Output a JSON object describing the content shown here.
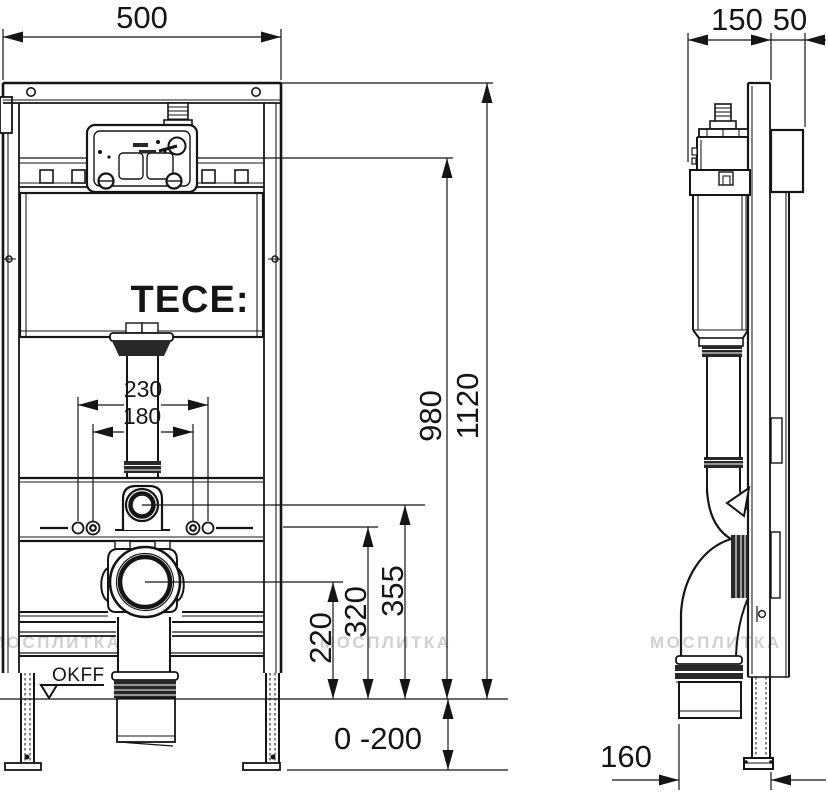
{
  "labels": {
    "logo": "TECE:",
    "floor_level": "OKFF",
    "watermark": "МОСПЛИТКА"
  },
  "dimensions": {
    "frame_width": "500",
    "install_depth": "150",
    "plate_depth": "50",
    "total_height": "1120",
    "upper_fixing_height": "980",
    "fixing_spacing_outer": "230",
    "fixing_spacing_inner": "180",
    "flush_pipe_height": "355",
    "anchor_height": "320",
    "drain_center_height": "220",
    "leg_adjustment": "0 -200",
    "drain_offset": "160"
  }
}
